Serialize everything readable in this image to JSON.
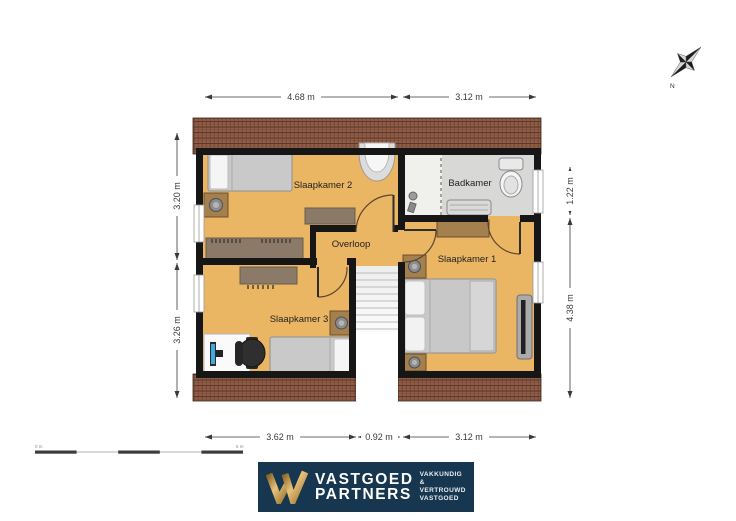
{
  "floor_plan": {
    "rooms": [
      {
        "label": "Slaapkamer 2"
      },
      {
        "label": "Badkamer"
      },
      {
        "label": "Overloop"
      },
      {
        "label": "Slaapkamer 1"
      },
      {
        "label": "Slaapkamer 3"
      }
    ],
    "dimensions": {
      "top": [
        "4.68 m",
        "3.12 m"
      ],
      "bottom": [
        "3.62 m",
        "0.92 m",
        "3.12 m"
      ],
      "left": [
        "3.20 m",
        "3.26 m"
      ],
      "right": [
        "1.22 m",
        "4.38 m"
      ]
    },
    "compass": {
      "north_label": "N"
    },
    "scale_bar": {
      "start_label": "0 m",
      "end_label": "5 m"
    },
    "colors": {
      "floor": "#EAB664",
      "bathroom_floor": "#D8D8D6",
      "roof": "#91604A",
      "wall": "#161616"
    }
  },
  "footer_logo": {
    "brand_word1": "VASTGOED",
    "brand_word2": "PARTNERS",
    "tagline": [
      "VAKKUNDIG &",
      "VERTROUWD",
      "VASTGOED"
    ],
    "colors": {
      "navy": "#16374F",
      "gold": "#C49A52"
    }
  }
}
